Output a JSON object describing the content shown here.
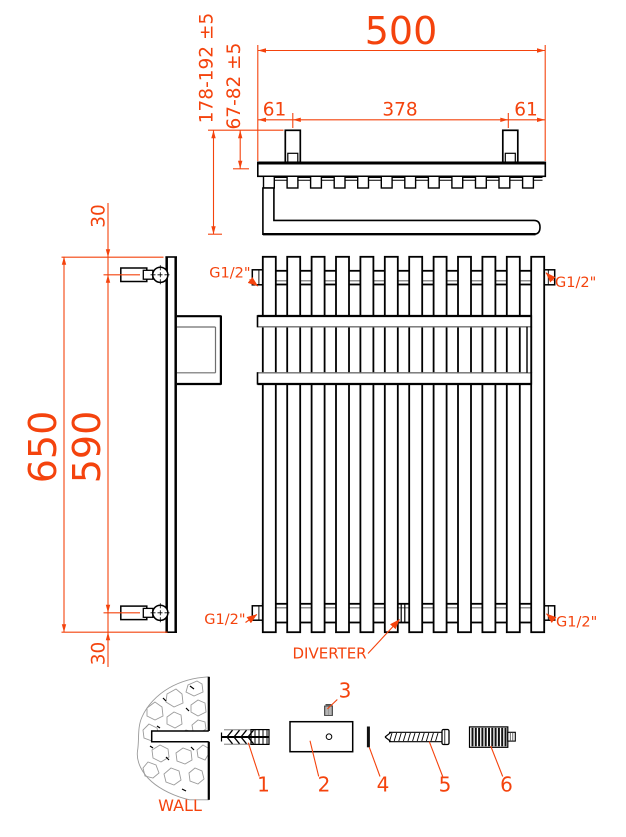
{
  "dimensions": {
    "overall_width": "500",
    "bracket_offset_left": "61",
    "bracket_spacing": "378",
    "bracket_offset_right": "61",
    "wall_to_rail": "178-192 ±5",
    "wall_to_tube_axis": "67-82 ±5",
    "overall_height": "650",
    "connection_spacing": "590",
    "top_connection_offset": "30",
    "bottom_connection_offset": "30"
  },
  "connections": {
    "top_left": "G1/2\"",
    "top_right": "G1/2\"",
    "bottom_left": "G1/2\"",
    "bottom_right": "G1/2\"",
    "diverter": "DIVERTER"
  },
  "mounting": {
    "wall_label": "WALL",
    "parts": [
      "1",
      "2",
      "3",
      "4",
      "5",
      "6"
    ]
  },
  "colors": {
    "dimension": "#f4430d",
    "line": "#000000",
    "secondary_line": "#6e6e6e"
  }
}
